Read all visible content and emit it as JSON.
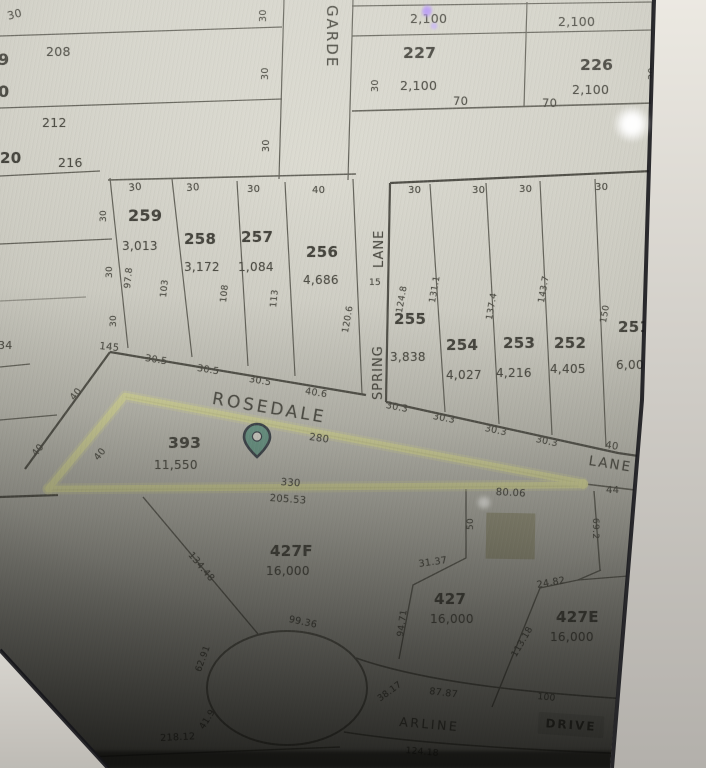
{
  "colors": {
    "highlight_yellow": "#eef0a0",
    "pin_fill": "#5f9f8c",
    "pin_outline": "#1e2836",
    "building_fill": "#9c997b",
    "paper": "#d3d2c9",
    "ink": "#34332c"
  },
  "streets": {
    "garden": "GARDE",
    "spring": "SPRING",
    "lane_word": "LANE",
    "rosedale": "ROSEDALE",
    "lane_right": "LANE",
    "arline": "ARLINE",
    "drive": "DRIVE"
  },
  "parcels": {
    "p227": {
      "id": "227",
      "area": "2,100"
    },
    "p226": {
      "id": "226",
      "area": "2,100"
    },
    "p259": {
      "id": "259",
      "area": "3,013"
    },
    "p258": {
      "id": "258",
      "area": "3,172"
    },
    "p257": {
      "id": "257",
      "area": "1,084"
    },
    "p256": {
      "id": "256",
      "area": "4,686"
    },
    "p255": {
      "id": "255",
      "area": "3,838"
    },
    "p254": {
      "id": "254",
      "area": "4,027"
    },
    "p253": {
      "id": "253",
      "area": "4,216"
    },
    "p252": {
      "id": "252",
      "area": "4,405"
    },
    "p251": {
      "id": "251",
      "area": "6,00"
    },
    "p393": {
      "id": "393",
      "area": "11,550"
    },
    "p427f": {
      "id": "427F",
      "area": "16,000"
    },
    "p427": {
      "id": "427",
      "area": "16,000"
    },
    "p427e": {
      "id": "427E",
      "area": "16,000"
    }
  },
  "misc": {
    "n30_tl": "30",
    "n208": "208",
    "n9": "9",
    "n0": "0",
    "n212": "212",
    "n20": "20",
    "n216": "216",
    "n34": "34",
    "a2100_left": "2,100",
    "a2100_right": "2,100",
    "f70_227": "70",
    "f70_226": "70",
    "lane_15": "15"
  },
  "dims": {
    "g30_1": "30",
    "g30_2": "30",
    "g30_3": "30",
    "g30_227": "30",
    "g30_226": "30",
    "g30_tr": "30",
    "w30_1": "30",
    "w30_2": "30",
    "w30_3": "30",
    "w40_256": "40",
    "e30_1": "30",
    "e30_2": "30",
    "e30_3": "30",
    "v978": "97.8",
    "v103": "103",
    "v108": "108",
    "v113": "113",
    "v1206": "120.6",
    "v145": "145",
    "v305_1": "30.5",
    "v305_2": "30.5",
    "v305_3": "30.5",
    "v406": "40.6",
    "v1248": "124.8",
    "v1311": "131.1",
    "v1374": "137.4",
    "v1437": "143.7",
    "v150": "150",
    "w30_255": "30",
    "w30_254": "30",
    "w30_253": "30",
    "w30_252": "30",
    "f303_1": "30.3",
    "f303_2": "30.3",
    "f303_3": "30.3",
    "f303_4": "30.3",
    "f40": "40",
    "z40_1": "40",
    "z40_2": "40",
    "z40_3": "40",
    "v280": "280",
    "v330": "330",
    "v20553": "205.53",
    "v44": "44",
    "v8006": "80.06",
    "v13448": "134.48",
    "v50": "50",
    "v3137": "31.37",
    "v692": "69.2",
    "v9471": "94.71",
    "v2482": "24.82",
    "v11318": "113.18",
    "v9936": "99.36",
    "v6291": "62.91",
    "v419": "41.9",
    "v21812": "218.12",
    "v3817": "38.17",
    "v8787": "87.87",
    "v100": "100",
    "v12418": "124.18"
  }
}
